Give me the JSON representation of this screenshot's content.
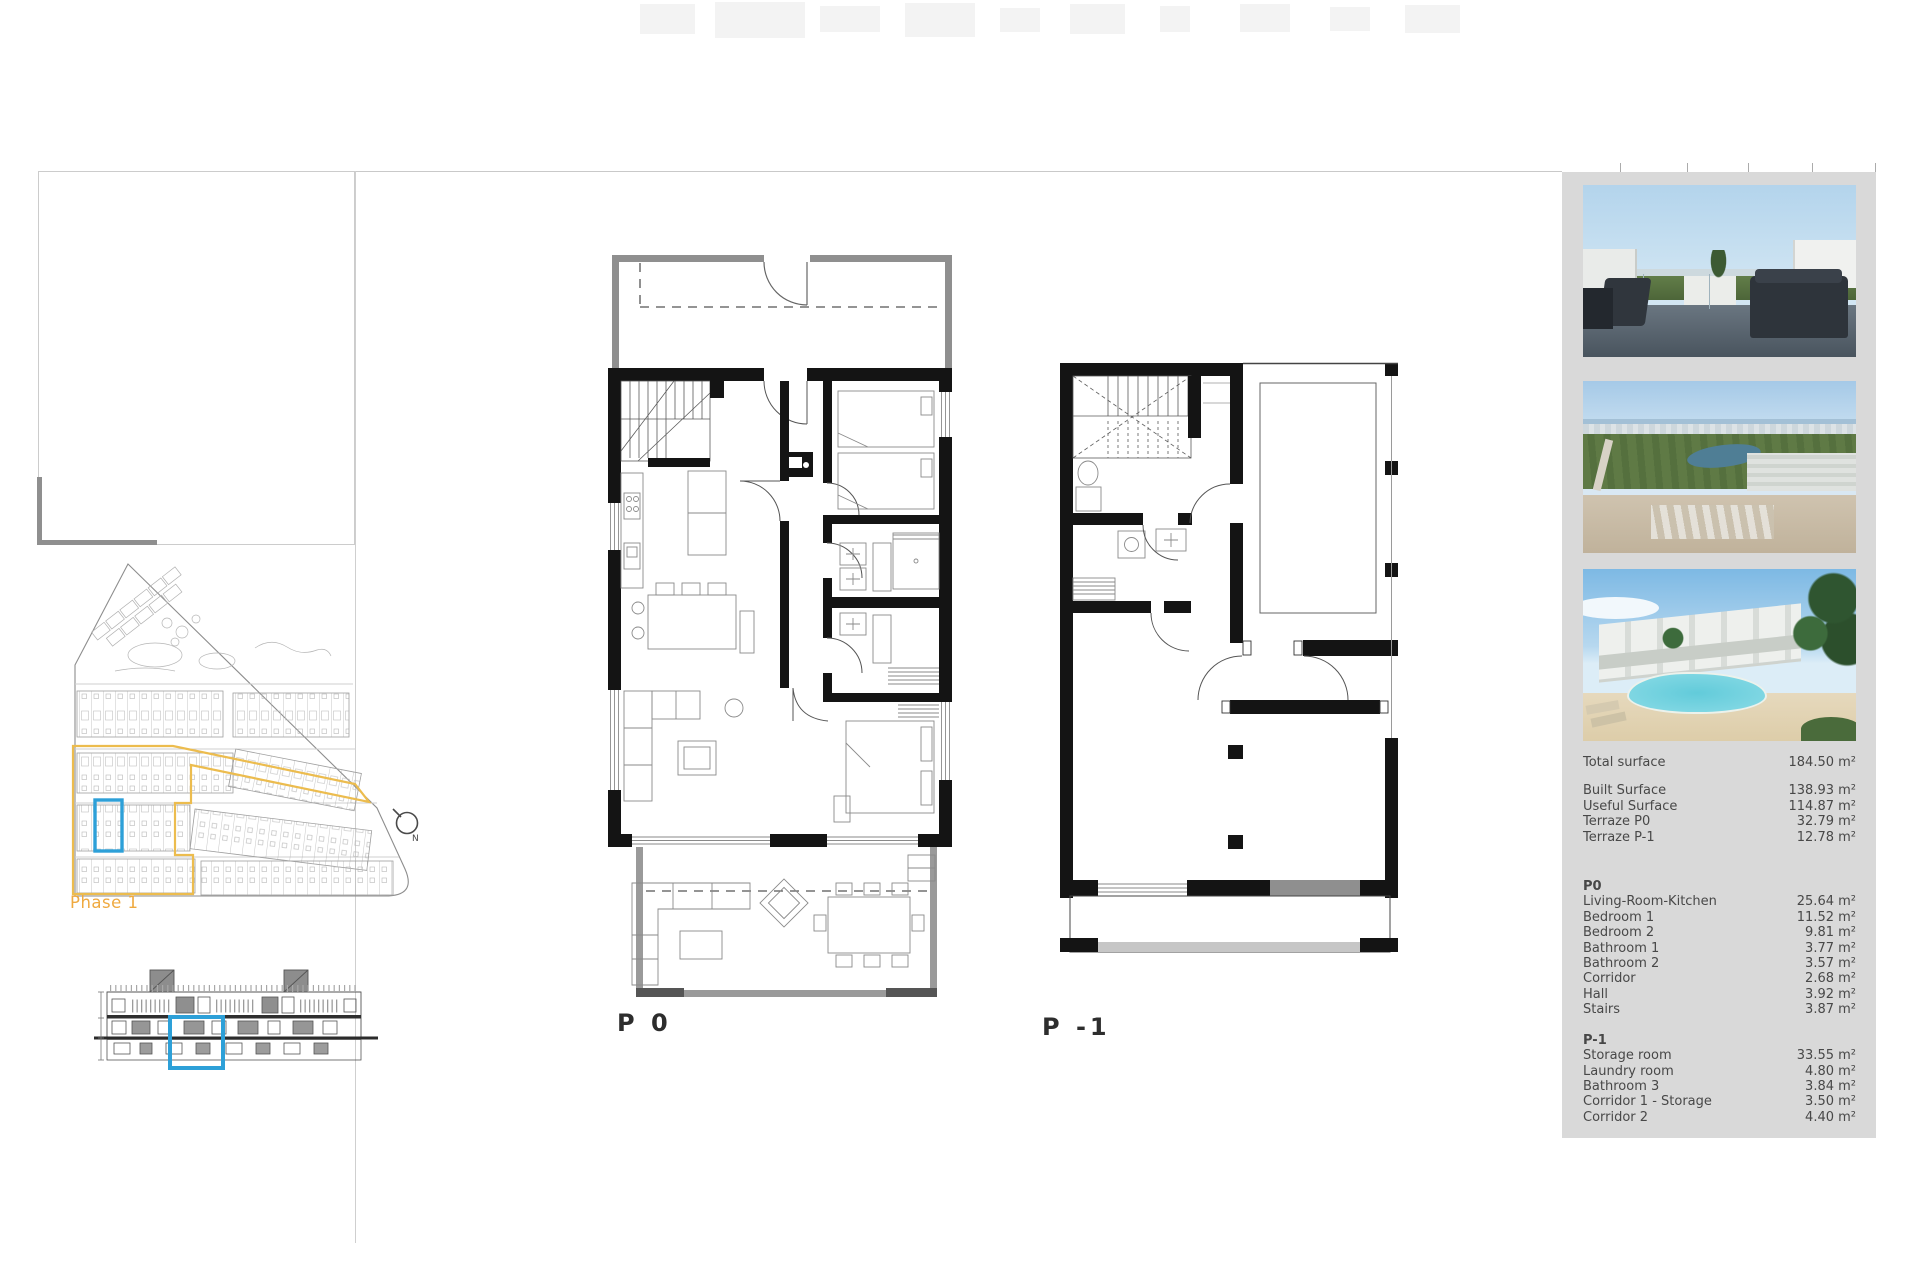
{
  "plans": {
    "p0_label": "P 0",
    "p1_label": "P -1"
  },
  "site": {
    "phase_label": "Phase 1",
    "phase_color": "#efa93f",
    "highlight_color": "#2da0d8",
    "compass_label": "N"
  },
  "panel": {
    "background": "#d9d9d9",
    "photos": [
      {
        "name": "roof-terrace-render"
      },
      {
        "name": "aerial-coast-view"
      },
      {
        "name": "pool-buildings-render"
      }
    ],
    "summary": {
      "total": {
        "label": "Total surface",
        "value": "184.50 m²"
      },
      "rows": [
        {
          "label": "Built Surface",
          "value": "138.93 m²"
        },
        {
          "label": "Useful Surface",
          "value": "114.87 m²"
        },
        {
          "label": "Terraze P0",
          "value": "32.79 m²"
        },
        {
          "label": "Terraze P-1",
          "value": "12.78 m²"
        }
      ]
    },
    "p0": {
      "heading": "P0",
      "rooms": [
        {
          "label": "Living-Room-Kitchen",
          "value": "25.64 m²"
        },
        {
          "label": "Bedroom 1",
          "value": "11.52 m²"
        },
        {
          "label": "Bedroom 2",
          "value": "9.81 m²"
        },
        {
          "label": "Bathroom 1",
          "value": "3.77 m²"
        },
        {
          "label": "Bathroom 2",
          "value": "3.57 m²"
        },
        {
          "label": "Corridor",
          "value": "2.68 m²"
        },
        {
          "label": "Hall",
          "value": "3.92 m²"
        },
        {
          "label": "Stairs",
          "value": "3.87 m²"
        }
      ]
    },
    "p1": {
      "heading": "P-1",
      "rooms": [
        {
          "label": "Storage room",
          "value": "33.55 m²"
        },
        {
          "label": "Laundry room",
          "value": "4.80 m²"
        },
        {
          "label": "Bathroom 3",
          "value": "3.84 m²"
        },
        {
          "label": "Corridor 1 - Storage",
          "value": "3.50 m²"
        },
        {
          "label": "Corridor 2",
          "value": "4.40 m²"
        }
      ]
    }
  }
}
